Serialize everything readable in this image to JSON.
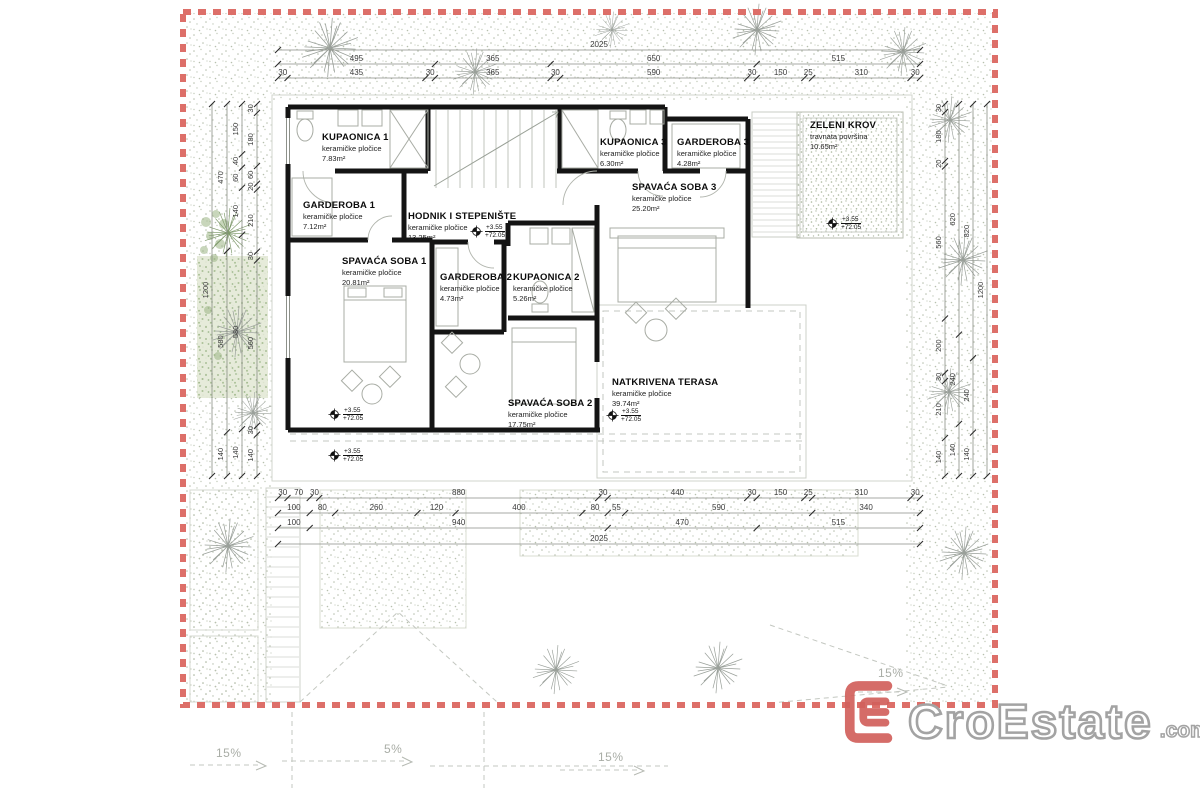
{
  "colors": {
    "border_red": "#dd6f69",
    "logo_red": "#d2605c",
    "wall_black": "#141414",
    "vegetation_green": "#8fae7c"
  },
  "rooms": [
    {
      "name": "KUPAONICA 1",
      "material": "keramičke pločice",
      "area": "7.83m²"
    },
    {
      "name": "GARDEROBA 1",
      "material": "keramičke pločice",
      "area": "7.12m²"
    },
    {
      "name": "HODNIK I STEPENIŠTE",
      "material": "keramičke pločice",
      "area": "13.25m²"
    },
    {
      "name": "SPAVAĆA SOBA 1",
      "material": "keramičke pločice",
      "area": "20.81m²"
    },
    {
      "name": "GARDEROBA 2",
      "material": "keramičke pločice",
      "area": "4.73m²"
    },
    {
      "name": "KUPAONICA 2",
      "material": "keramičke pločice",
      "area": "5.26m²"
    },
    {
      "name": "SPAVAĆA SOBA 2",
      "material": "keramičke pločice",
      "area": "17.75m²"
    },
    {
      "name": "KUPAONICA 3",
      "material": "keramičke pločice",
      "area": "6.30m²"
    },
    {
      "name": "GARDEROBA 3",
      "material": "keramičke pločice",
      "area": "4.28m²"
    },
    {
      "name": "SPAVAĆA SOBA 3",
      "material": "keramičke pločice",
      "area": "25.20m²"
    },
    {
      "name": "NATKRIVENA TERASA",
      "material": "keramičke pločice",
      "area": "39.74m²"
    },
    {
      "name": "ZELENI KROV",
      "material": "travnata površina",
      "area": "10.65m²"
    }
  ],
  "levels": {
    "relative": "+3.55",
    "absolute": "+72.05"
  },
  "slopes": {
    "left": "15%",
    "center": "5%",
    "mid_right": "15%",
    "near_logo": "15%"
  },
  "dimensions": {
    "top": [
      [
        2025
      ],
      [
        495,
        365,
        650,
        515
      ],
      [
        30,
        435,
        30,
        365,
        30,
        590,
        30,
        150,
        25,
        310,
        30
      ]
    ],
    "bottom": [
      [
        30,
        70,
        30,
        880,
        30,
        440,
        30,
        150,
        25,
        310,
        30
      ],
      [
        100,
        80,
        260,
        120,
        400,
        80,
        55,
        590,
        340
      ],
      [
        100,
        940,
        470,
        515
      ],
      [
        2025
      ]
    ],
    "left": [
      [
        1200
      ],
      [
        470,
        580,
        140
      ],
      [
        150,
        40,
        60,
        140,
        580,
        140
      ],
      [
        30,
        180,
        60,
        20,
        210,
        30,
        560,
        30,
        140
      ]
    ],
    "right": [
      [
        30,
        180,
        20,
        560,
        200,
        30,
        210,
        140
      ],
      [
        620,
        240,
        140
      ],
      [
        820,
        240,
        140
      ],
      [
        1200
      ]
    ]
  },
  "logo": {
    "name": "CroEstate",
    "tld": ".com",
    "icon": "E-bracket"
  }
}
